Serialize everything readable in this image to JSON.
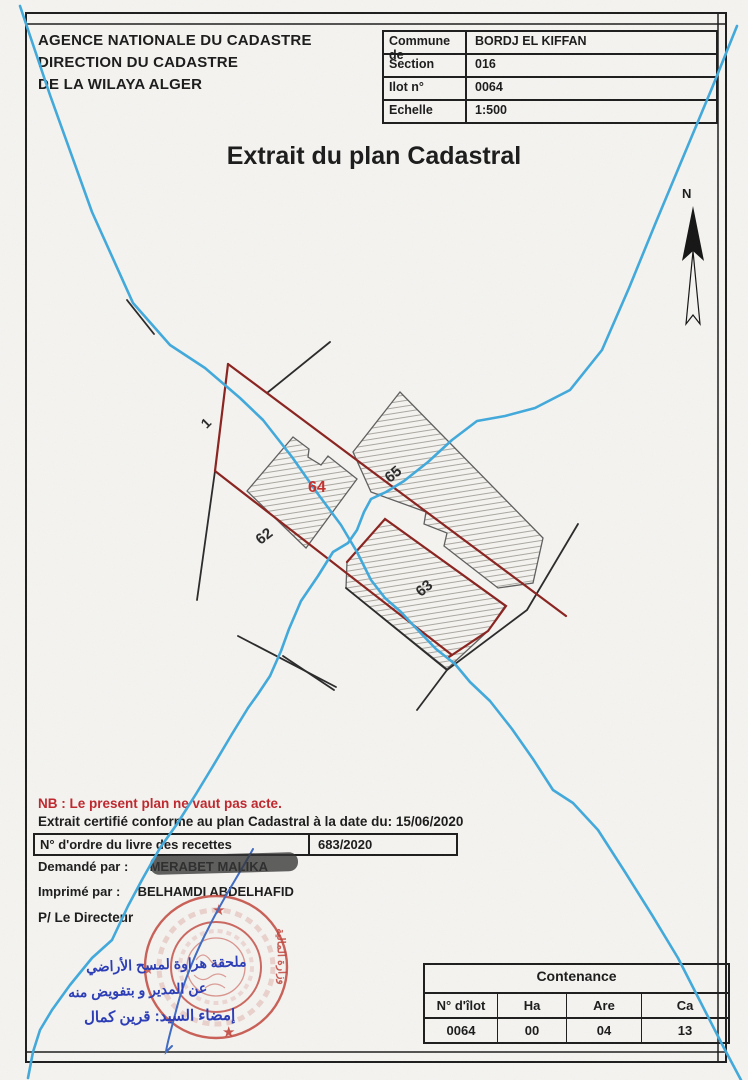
{
  "header": {
    "line1": "AGENCE NATIONALE DU CADASTRE",
    "line2": "DIRECTION DU CADASTRE",
    "line3": "DE LA WILAYA  ALGER"
  },
  "info_table": {
    "rows": [
      {
        "label": "Commune de",
        "value": "BORDJ EL KIFFAN"
      },
      {
        "label": "Section",
        "value": "016"
      },
      {
        "label": "Ilot n°",
        "value": "0064"
      },
      {
        "label": "Echelle",
        "value": "1:500"
      }
    ]
  },
  "title": "Extrait du plan Cadastral",
  "compass": {
    "label": "N"
  },
  "map": {
    "labels": {
      "parcel_1": "1",
      "parcel_62": "62",
      "parcel_63": "63",
      "parcel_64": "64",
      "parcel_65": "65"
    }
  },
  "notes": {
    "nb": "NB : Le present plan ne vaut pas acte.",
    "certified": "Extrait certifié conforme au plan Cadastral à la date du: 15/06/2020"
  },
  "recettes": {
    "label": "N° d'ordre du livre des recettes",
    "value": "683/2020"
  },
  "signatories": {
    "requested_label": "Demandé par :",
    "requested_value": "MERABET MALIKA",
    "printed_label": "Imprimé par  :",
    "printed_value": "BELHAMDI ABDELHAFID",
    "director": "P/ Le Directeur"
  },
  "stamp": {
    "annex_line1": "ملحقة هراوة لمسح الأراضي",
    "annex_line2": "عن المدير و بتفويض منه",
    "annex_line3": "إمضاء السيد: قرين كمال",
    "ministry": "وزارة المالية"
  },
  "contenance": {
    "title": "Contenance",
    "headers": [
      "N° d'îlot",
      "Ha",
      "Are",
      "Ca"
    ],
    "values": [
      "0064",
      "00",
      "04",
      "13"
    ]
  },
  "colors": {
    "boundary_red": "#8b231f",
    "label_red": "#c5312e",
    "water_blue": "#41aadd",
    "stamp_red": "#c2453c",
    "ink_blue": "#3f6cc4"
  }
}
